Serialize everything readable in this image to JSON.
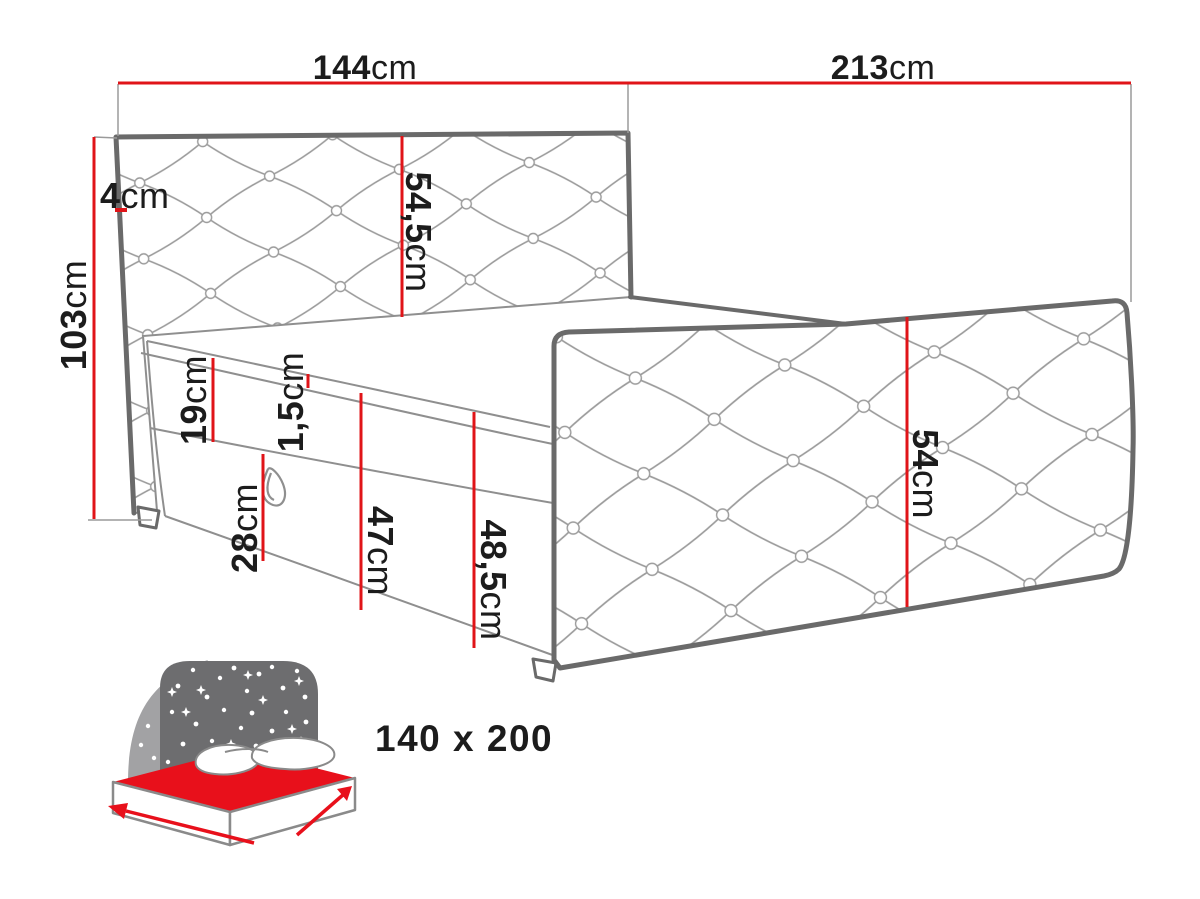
{
  "diagram": {
    "title": "bed-dimension-diagram",
    "colors": {
      "red": "#e01418",
      "outline_gray": "#6a6a6a",
      "thin_gray": "#8f8f8f",
      "text": "#1c1c1c",
      "icon_gray": "#6d6d6f",
      "icon_light_gray": "#a2a2a4",
      "icon_red": "#e8101b",
      "icon_text_gray": "#6a6a6c"
    },
    "dims": {
      "width": {
        "value": "144",
        "unit": "cm"
      },
      "length": {
        "value": "213",
        "unit": "cm"
      },
      "total_height": {
        "value": "103",
        "unit": "cm"
      },
      "headboard_edge": {
        "value": "4",
        "unit": "cm"
      },
      "headboard_panel": {
        "value": "54,5",
        "unit": "cm"
      },
      "mattress": {
        "value": "19",
        "unit": "cm"
      },
      "topper": {
        "value": "1,5",
        "unit": "cm"
      },
      "base": {
        "value": "28",
        "unit": "cm"
      },
      "side_front": {
        "value": "47",
        "unit": "cm"
      },
      "side_back": {
        "value": "48,5",
        "unit": "cm"
      },
      "side_panel": {
        "value": "54",
        "unit": "cm"
      }
    },
    "badge": {
      "size_label": "140 x 200"
    }
  }
}
